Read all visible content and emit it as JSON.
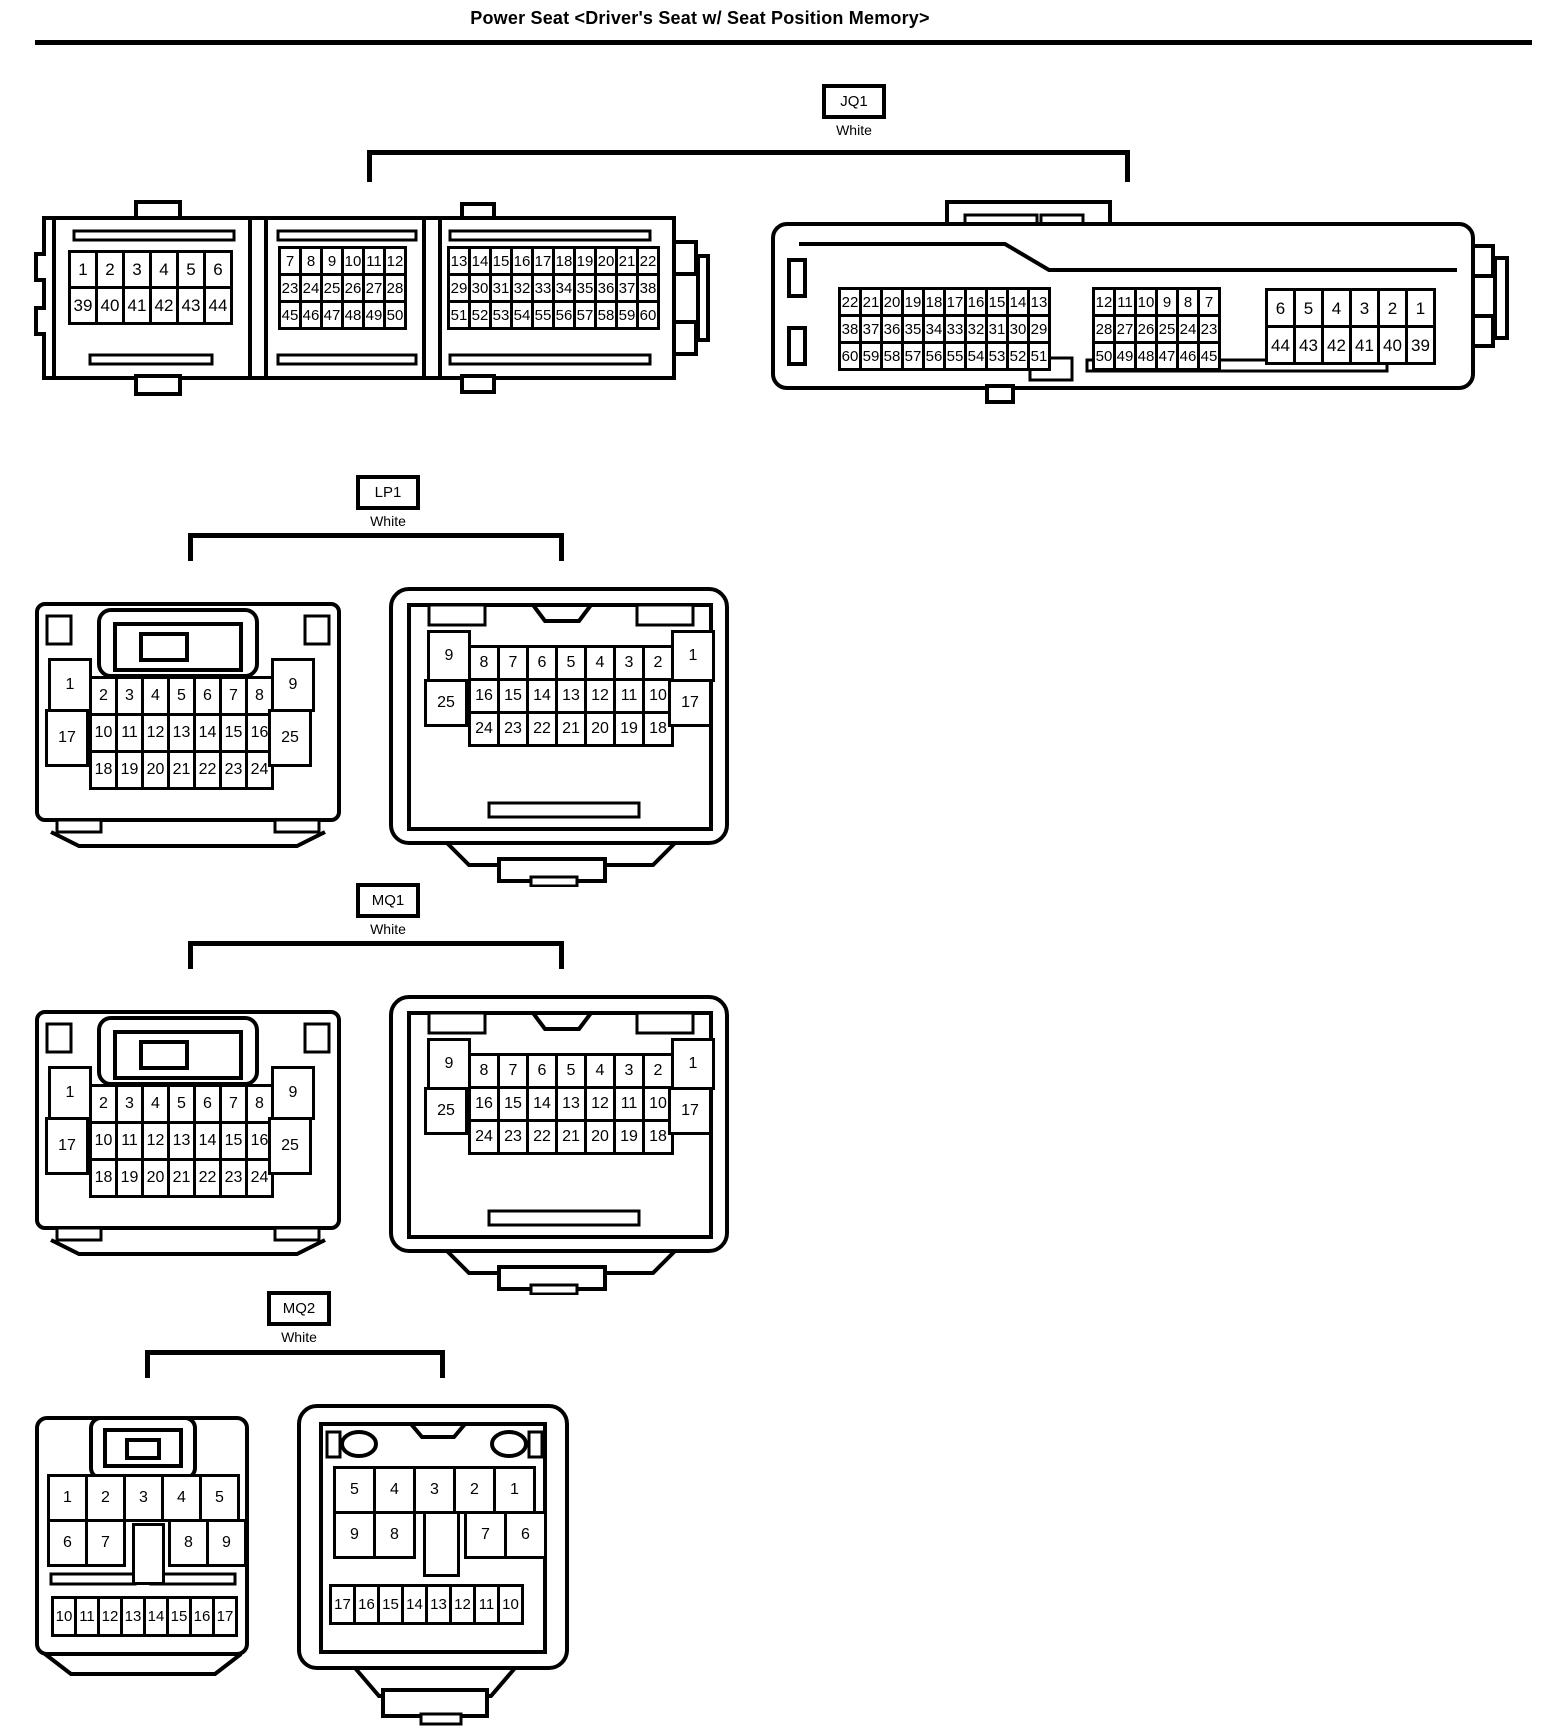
{
  "title": "Power Seat <Driver's Seat w/ Seat Position Memory>",
  "line_color": "#000000",
  "connectors": [
    {
      "id": "JQ1",
      "label": "JQ1",
      "color": "White",
      "left_view": {
        "block_a": [
          [
            "1",
            "2",
            "3",
            "4",
            "5",
            "6"
          ],
          [
            "39",
            "40",
            "41",
            "42",
            "43",
            "44"
          ]
        ],
        "block_b": [
          [
            "7",
            "8",
            "9",
            "10",
            "11",
            "12"
          ],
          [
            "23",
            "24",
            "25",
            "26",
            "27",
            "28"
          ],
          [
            "45",
            "46",
            "47",
            "48",
            "49",
            "50"
          ]
        ],
        "block_c": [
          [
            "13",
            "14",
            "15",
            "16",
            "17",
            "18",
            "19",
            "20",
            "21",
            "22"
          ],
          [
            "29",
            "30",
            "31",
            "32",
            "33",
            "34",
            "35",
            "36",
            "37",
            "38"
          ],
          [
            "51",
            "52",
            "53",
            "54",
            "55",
            "56",
            "57",
            "58",
            "59",
            "60"
          ]
        ]
      },
      "right_view": {
        "block_c": [
          [
            "22",
            "21",
            "20",
            "19",
            "18",
            "17",
            "16",
            "15",
            "14",
            "13"
          ],
          [
            "38",
            "37",
            "36",
            "35",
            "34",
            "33",
            "32",
            "31",
            "30",
            "29"
          ],
          [
            "60",
            "59",
            "58",
            "57",
            "56",
            "55",
            "54",
            "53",
            "52",
            "51"
          ]
        ],
        "block_b": [
          [
            "12",
            "11",
            "10",
            "9",
            "8",
            "7"
          ],
          [
            "28",
            "27",
            "26",
            "25",
            "24",
            "23"
          ],
          [
            "50",
            "49",
            "48",
            "47",
            "46",
            "45"
          ]
        ],
        "block_a": [
          [
            "6",
            "5",
            "4",
            "3",
            "2",
            "1"
          ],
          [
            "44",
            "43",
            "42",
            "41",
            "40",
            "39"
          ]
        ]
      }
    },
    {
      "id": "LP1",
      "label": "LP1",
      "color": "White",
      "left_view": {
        "col_left": [
          "1",
          "17"
        ],
        "grid": [
          [
            "2",
            "3",
            "4",
            "5",
            "6",
            "7",
            "8"
          ],
          [
            "10",
            "11",
            "12",
            "13",
            "14",
            "15",
            "16"
          ],
          [
            "18",
            "19",
            "20",
            "21",
            "22",
            "23",
            "24"
          ]
        ],
        "col_right": [
          "9",
          "25"
        ]
      },
      "right_view": {
        "col_left": [
          "9",
          "25"
        ],
        "grid": [
          [
            "8",
            "7",
            "6",
            "5",
            "4",
            "3",
            "2"
          ],
          [
            "16",
            "15",
            "14",
            "13",
            "12",
            "11",
            "10"
          ],
          [
            "24",
            "23",
            "22",
            "21",
            "20",
            "19",
            "18"
          ]
        ],
        "col_right": [
          "1",
          "17"
        ]
      }
    },
    {
      "id": "MQ1",
      "label": "MQ1",
      "color": "White",
      "left_view": {
        "col_left": [
          "1",
          "17"
        ],
        "grid": [
          [
            "2",
            "3",
            "4",
            "5",
            "6",
            "7",
            "8"
          ],
          [
            "10",
            "11",
            "12",
            "13",
            "14",
            "15",
            "16"
          ],
          [
            "18",
            "19",
            "20",
            "21",
            "22",
            "23",
            "24"
          ]
        ],
        "col_right": [
          "9",
          "25"
        ]
      },
      "right_view": {
        "col_left": [
          "9",
          "25"
        ],
        "grid": [
          [
            "8",
            "7",
            "6",
            "5",
            "4",
            "3",
            "2"
          ],
          [
            "16",
            "15",
            "14",
            "13",
            "12",
            "11",
            "10"
          ],
          [
            "24",
            "23",
            "22",
            "21",
            "20",
            "19",
            "18"
          ]
        ],
        "col_right": [
          "1",
          "17"
        ]
      }
    },
    {
      "id": "MQ2",
      "label": "MQ2",
      "color": "White",
      "left_view": {
        "row1": [
          "1",
          "2",
          "3",
          "4",
          "5"
        ],
        "row2": [
          "6",
          "7",
          "",
          "8",
          "9"
        ],
        "strip": [
          "10",
          "11",
          "12",
          "13",
          "14",
          "15",
          "16",
          "17"
        ]
      },
      "right_view": {
        "row1": [
          "5",
          "4",
          "3",
          "2",
          "1"
        ],
        "row2": [
          "9",
          "8",
          "",
          "7",
          "6"
        ],
        "strip": [
          "17",
          "16",
          "15",
          "14",
          "13",
          "12",
          "11",
          "10"
        ]
      }
    }
  ]
}
